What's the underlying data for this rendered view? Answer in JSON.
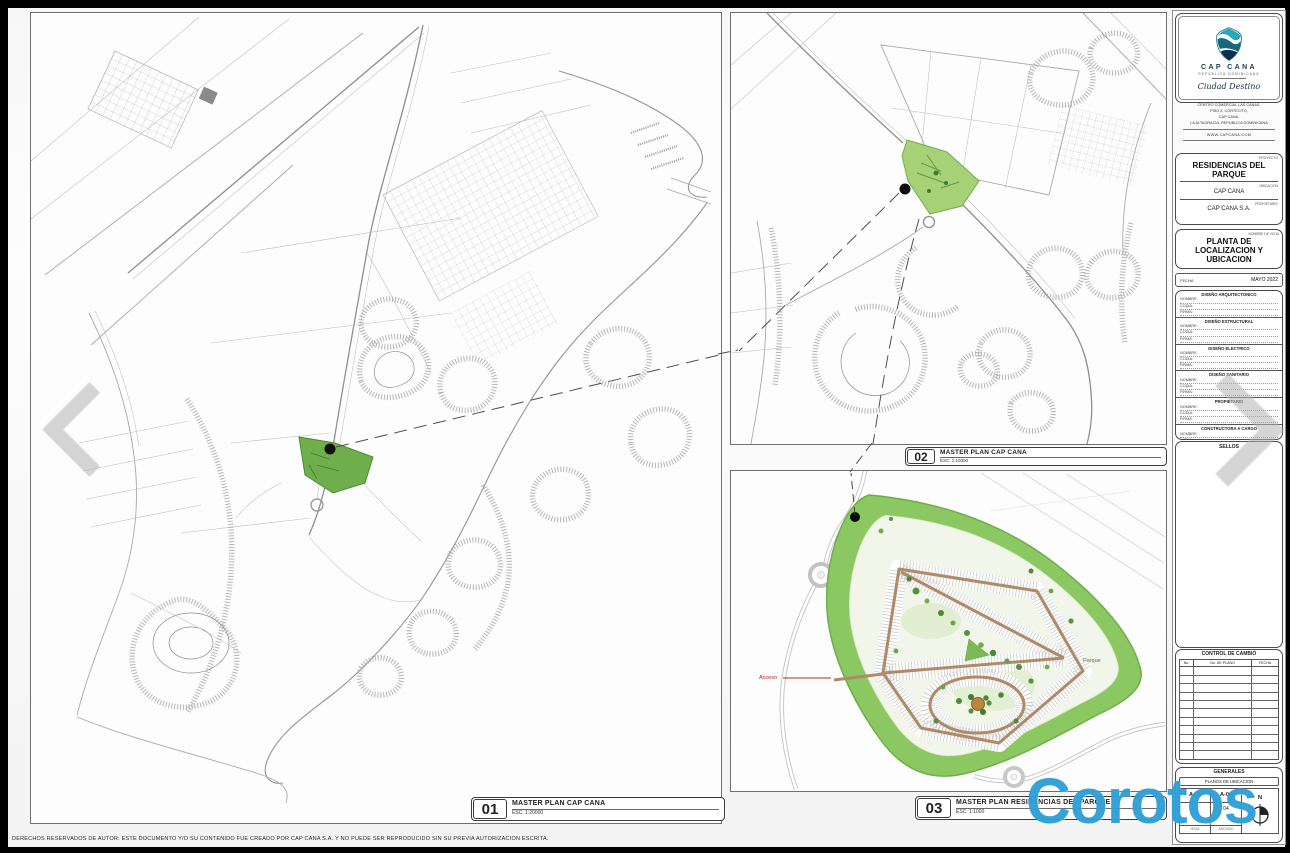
{
  "sheet": {
    "footer": "DERECHOS RESERVADOS DE AUTOR: ESTE DOCUMENTO Y/O SU CONTENIDO FUE CREADO POR CAP CANA S.A. Y NO PUEDE SER REPRODUCIDO SIN SU PREVIA AUTORIZACION ESCRITA.",
    "watermark": "Corotos"
  },
  "panels": {
    "p01": {
      "number": "01",
      "title": "MASTER PLAN CAP CANA",
      "scale": "ESC: 1:20000"
    },
    "p02": {
      "number": "02",
      "title": "MASTER PLAN CAP CANA",
      "scale": "ESC: 1:10000"
    },
    "p03": {
      "number": "03",
      "title": "MASTER PLAN RESIDENCIAS DEL PARQUE",
      "scale": "ESC: 1:1000",
      "parque_label": "Parque",
      "acceso_label": "Acceso"
    }
  },
  "titleblock": {
    "brand": {
      "name": "CAP CANA",
      "country": "REPÚBLICA DOMINICANA",
      "tagline": "Ciudad Destino"
    },
    "address": [
      "CENTRO COMERCIAL LAS CANAS,",
      "PISO 2, CORTECITO,",
      "CAP CANA,",
      "LA ALTAGRACIA, REPUBLICA DOMINICANA"
    ],
    "website": "WWW.CAPCANA.COM",
    "project": {
      "label": "PROYECTO",
      "value": "RESIDENCIAS DEL PARQUE"
    },
    "location": {
      "label": "UBICACION",
      "value": "CAP CANA"
    },
    "owner": {
      "label": "PROPIETARIO",
      "value": "CAP CANA S.A."
    },
    "sheet_name": {
      "label": "NOMBRE DE HOJA",
      "value": "PLANTA DE LOCALIZACION Y UBICACION"
    },
    "date": {
      "label": "FECHA",
      "value": "MAYO 2022"
    },
    "signatures": [
      {
        "title": "DISEÑO ARQUITECTONICO",
        "f0": "NOMBRE:",
        "f1": "CODIA:",
        "f2": "FIRMA:"
      },
      {
        "title": "DISEÑO ESTRUCTURAL",
        "f0": "NOMBRE:",
        "f1": "CODIA:",
        "f2": "FIRMA:"
      },
      {
        "title": "DISEÑO ELECTRICO",
        "f0": "NOMBRE:",
        "f1": "CODIA:",
        "f2": "FIRMA:"
      },
      {
        "title": "DISEÑO SANITARIO",
        "f0": "NOMBRE:",
        "f1": "CODIA:",
        "f2": "FIRMA:"
      },
      {
        "title": "PROPIETARIO",
        "f0": "NOMBRE:",
        "f1": "CODIA:",
        "f2": "FIRMA:"
      },
      {
        "title": "CONSTRUCTORA A CARGO",
        "f0": "NOMBRE:",
        "f1": "FIRMA:"
      }
    ],
    "sellos": "SELLOS",
    "control": {
      "title": "CONTROL DE CAMBIO",
      "col_no": "No.",
      "col_plano": "No. DE PLANO",
      "col_fecha": "FECHA"
    },
    "generales": {
      "title": "GENERALES",
      "subtitle": "PLANOS DE UBICACION",
      "sheet_code": "A-01",
      "file_code": "A-04",
      "sheet_num": "01",
      "file_num": "04",
      "label_sheet": "HOJA",
      "label_file": "ARCHIVO",
      "north": "N"
    }
  }
}
